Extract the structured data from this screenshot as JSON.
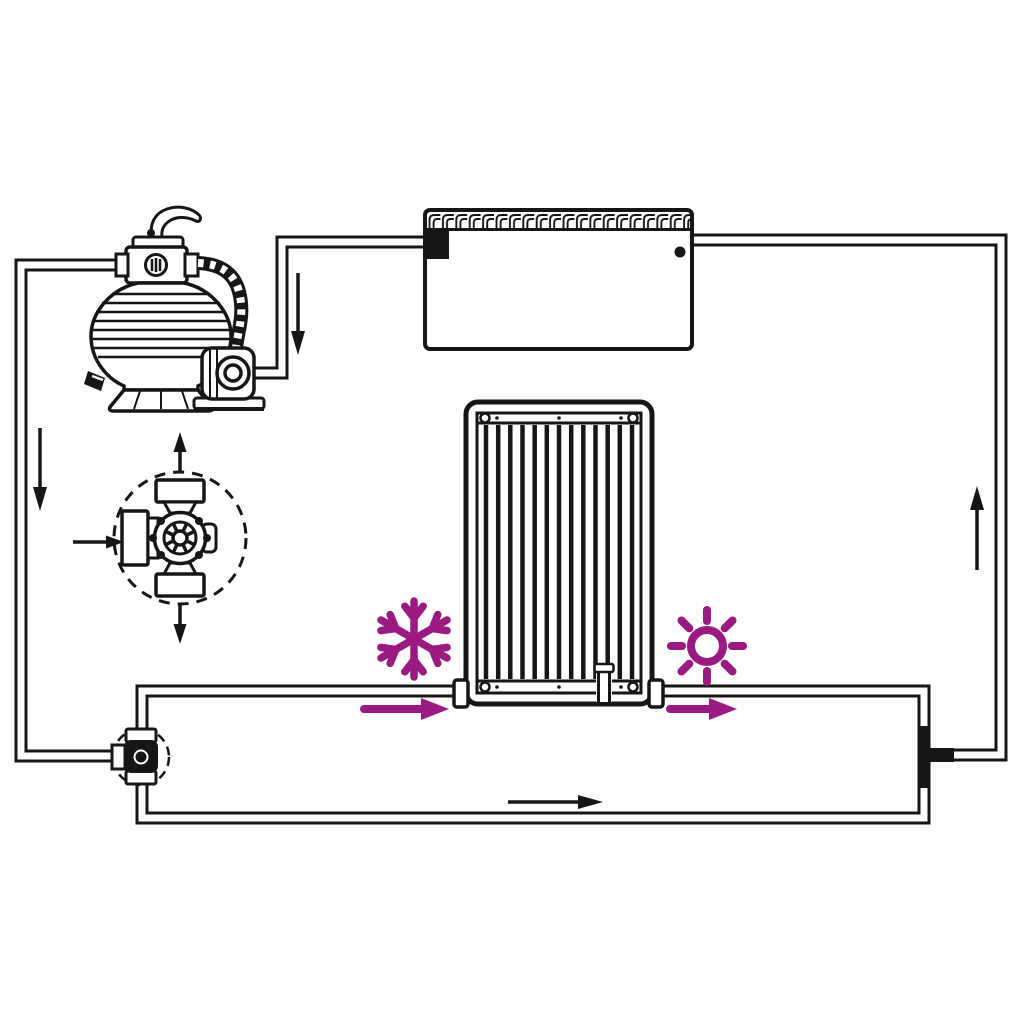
{
  "canvas": {
    "width": 1024,
    "height": 1024,
    "background": "#ffffff"
  },
  "colors": {
    "line": "#161616",
    "pipe_fill": "#ffffff",
    "accent": "#9b1a82"
  },
  "icons": [
    {
      "name": "snowflake-icon",
      "color": "#9b1a82"
    },
    {
      "name": "sun-icon",
      "color": "#9b1a82"
    }
  ],
  "components": [
    {
      "id": "sand-filter-pump",
      "parts": [
        "multiport-valve-handle",
        "multiport-valve",
        "pressure-gauge",
        "filter-tank",
        "corrugated-hose",
        "pump-motor"
      ]
    },
    {
      "id": "pool",
      "parts": [
        "tiled-edge",
        "skimmer-inlet",
        "return-outlet"
      ]
    },
    {
      "id": "solar-heating-panel",
      "parts": [
        "frame",
        "collector-tubes",
        "inlet-coupling",
        "outlet-coupling",
        "bottom-joint",
        "corner-screws"
      ]
    },
    {
      "id": "bypass-valve",
      "parts": [
        "dashed-highlight-circle",
        "valve-body",
        "top-port",
        "bottom-port",
        "side-port"
      ]
    },
    {
      "id": "bypass-valve-detail",
      "parts": [
        "dashed-circle",
        "top-port",
        "bottom-port",
        "side-port",
        "valve-wheel",
        "flange-bolts"
      ]
    },
    {
      "id": "tee-connector"
    }
  ],
  "pipes": [
    {
      "id": "pool-skimmer-to-pump"
    },
    {
      "id": "filter-valve-to-bypass-valve"
    },
    {
      "id": "bypass-valve-to-panel-inlet"
    },
    {
      "id": "panel-outlet-and-bypass-run-to-tee"
    },
    {
      "id": "tee-to-pool-return"
    }
  ],
  "flow_arrows": [
    {
      "id": "skimmer-line-down",
      "direction": "down",
      "color": "#161616"
    },
    {
      "id": "filter-line-down",
      "direction": "down",
      "color": "#161616"
    },
    {
      "id": "panel-inlet-right",
      "direction": "right",
      "color": "#9b1a82"
    },
    {
      "id": "panel-outlet-right",
      "direction": "right",
      "color": "#9b1a82"
    },
    {
      "id": "bypass-run-right",
      "direction": "right",
      "color": "#161616"
    },
    {
      "id": "return-line-up",
      "direction": "up",
      "color": "#161616"
    },
    {
      "id": "detail-inlet-right",
      "direction": "right",
      "color": "#161616"
    },
    {
      "id": "detail-outlet-up",
      "direction": "up",
      "color": "#161616"
    },
    {
      "id": "detail-outlet-down",
      "direction": "down",
      "color": "#161616"
    }
  ]
}
